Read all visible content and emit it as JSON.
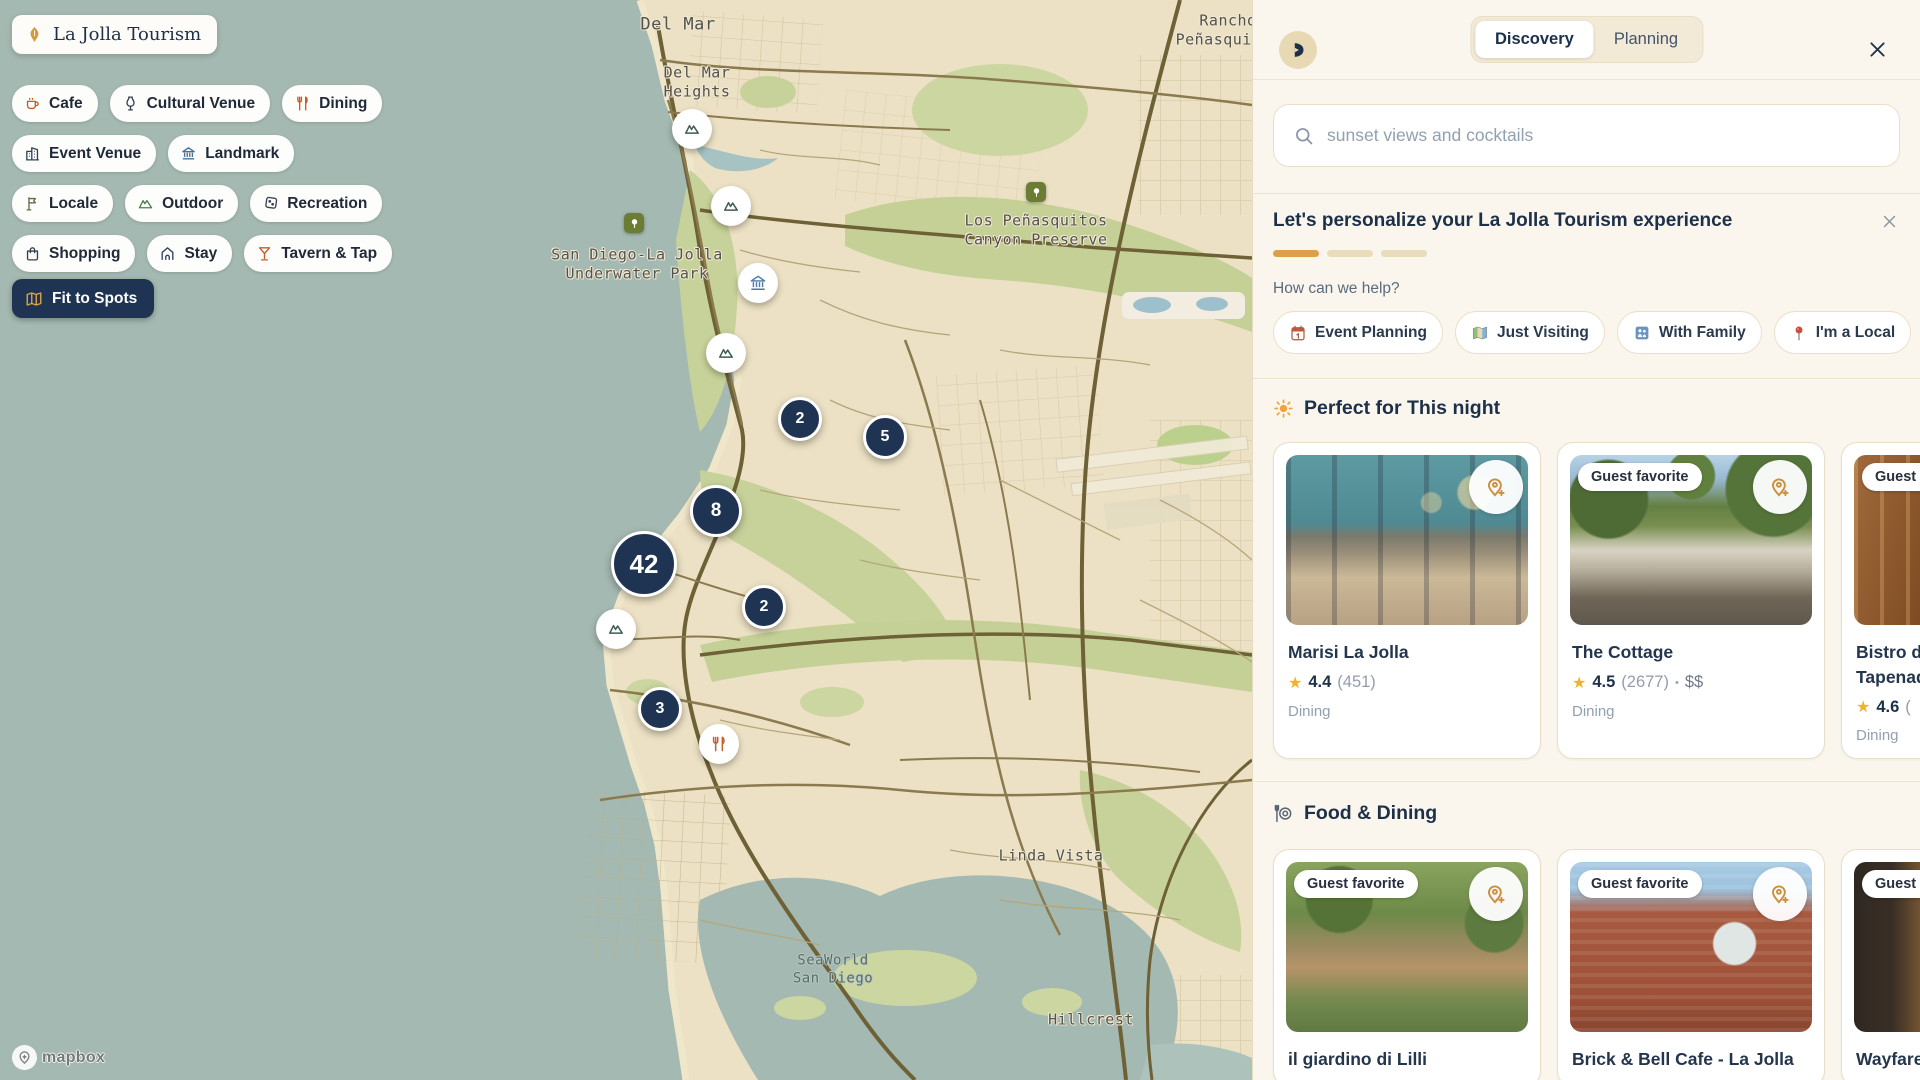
{
  "map": {
    "badge_title": "La Jolla Tourism",
    "categories": [
      {
        "label": "Cafe",
        "icon": "cafe-icon"
      },
      {
        "label": "Cultural Venue",
        "icon": "cultural-venue-icon"
      },
      {
        "label": "Dining",
        "icon": "dining-icon"
      },
      {
        "label": "Event Venue",
        "icon": "event-venue-icon"
      },
      {
        "label": "Landmark",
        "icon": "landmark-icon"
      },
      {
        "label": "Locale",
        "icon": "locale-icon"
      },
      {
        "label": "Outdoor",
        "icon": "outdoor-icon"
      },
      {
        "label": "Recreation",
        "icon": "recreation-icon"
      },
      {
        "label": "Shopping",
        "icon": "shopping-icon"
      },
      {
        "label": "Stay",
        "icon": "stay-icon"
      },
      {
        "label": "Tavern & Tap",
        "icon": "tavern-tap-icon"
      }
    ],
    "fit_button": {
      "label": "Fit to Spots",
      "icon": "folded-map-icon"
    },
    "clusters": [
      {
        "count": "2"
      },
      {
        "count": "5"
      },
      {
        "count": "8"
      },
      {
        "count": "42"
      },
      {
        "count": "2"
      },
      {
        "count": "3"
      }
    ],
    "labels": [
      {
        "line1": "Del Mar"
      },
      {
        "line1": "Del Mar",
        "line2": "Heights"
      },
      {
        "line1": "Rancho",
        "line2": "Peñasquitos"
      },
      {
        "line1": "San Diego-La Jolla",
        "line2": "Underwater Park"
      },
      {
        "line1": "Los Peñasquitos",
        "line2": "Canyon Preserve"
      },
      {
        "line1": "Linda Vista"
      },
      {
        "line1": "SeaWorld",
        "line2": "San Diego"
      },
      {
        "line1": "Hillcrest"
      }
    ],
    "attribution": "mapbox"
  },
  "panel": {
    "tabs": [
      {
        "label": "Discovery",
        "active": true
      },
      {
        "label": "Planning",
        "active": false
      }
    ],
    "search": {
      "placeholder": "sunset views and cocktails"
    },
    "personalize": {
      "title": "Let's personalize your La Jolla Tourism experience",
      "progress_filled": 1,
      "progress_total": 3,
      "question": "How can we help?",
      "options": [
        {
          "icon": "calendar-icon",
          "label": "Event Planning"
        },
        {
          "icon": "world-map-icon",
          "label": "Just Visiting"
        },
        {
          "icon": "family-icon",
          "label": "With Family"
        },
        {
          "icon": "pushpin-icon",
          "label": "I'm a Local"
        }
      ]
    },
    "sections": [
      {
        "icon": "sun-icon",
        "title": "Perfect for This night",
        "cards": [
          {
            "name": "Marisi La Jolla",
            "rating": "4.4",
            "reviews": "(451)",
            "category": "Dining"
          },
          {
            "name": "The Cottage",
            "badge": "Guest favorite",
            "rating": "4.5",
            "reviews": "(2677)",
            "separator": "•",
            "price": "$$",
            "category": "Dining"
          },
          {
            "name": "Bistro du Marché by Tapenade",
            "badge": "Guest favorite",
            "rating": "4.6",
            "reviews": "(",
            "category": "Dining"
          }
        ]
      },
      {
        "icon": "fork-plate-icon",
        "title": "Food & Dining",
        "cards": [
          {
            "name": "il giardino di Lilli",
            "badge": "Guest favorite"
          },
          {
            "name": "Brick & Bell Cafe - La Jolla",
            "badge": "Guest favorite"
          },
          {
            "name": "Wayfarer",
            "badge": "Guest favorite"
          }
        ]
      }
    ]
  },
  "colors": {
    "accent_orange": "#dd9f48",
    "navy": "#1f3352",
    "panel_cream": "#faf6ed",
    "star_gold": "#f1b32b"
  }
}
